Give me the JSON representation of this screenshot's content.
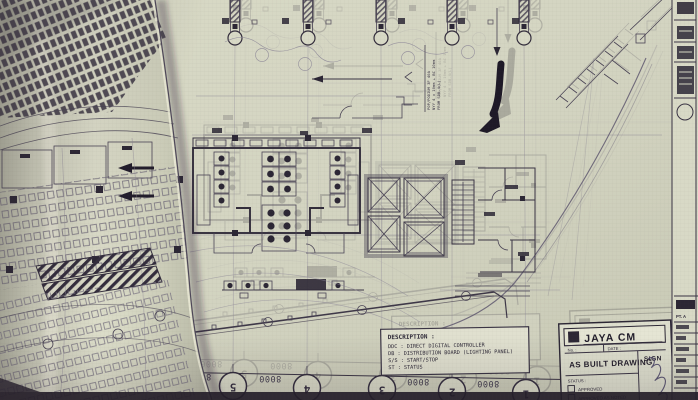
{
  "colors": {
    "paper": "#d6d7c4",
    "paper_light": "#e2e2d0",
    "line": "#3a3444",
    "ink": "#26212e"
  },
  "plan": {
    "dim_label": "8000",
    "grid_bubbles": [
      "5",
      "4",
      "3",
      "2",
      "1"
    ],
    "cable_tag": {
      "line1": "POP/PODIUM 3F 40A",
      "line2": "NYY 4 x 10mm + BC 10mm",
      "line3": "FROM SDB-4(L)"
    }
  },
  "description_box": {
    "title": "DESCRIPTION :",
    "entries": [
      "DDC : DIRECT DIGITAL CONTROLLER",
      "DB  : DISTRIBUTION BOARD (LIGHTING PANEL)",
      "S/S : START/STOP",
      "ST  : STATUS"
    ]
  },
  "title_block": {
    "company": "JAYA CM",
    "no_label": "No. :",
    "date_label": "DATE :",
    "drawing_type": "AS BUILT DRAWING",
    "sign_label": "SIGN",
    "status_label": "STATUS :",
    "status_options": [
      "APPROVED",
      "APPROVED AS NOTED"
    ]
  },
  "side_strip": {
    "company": "PT. A"
  }
}
